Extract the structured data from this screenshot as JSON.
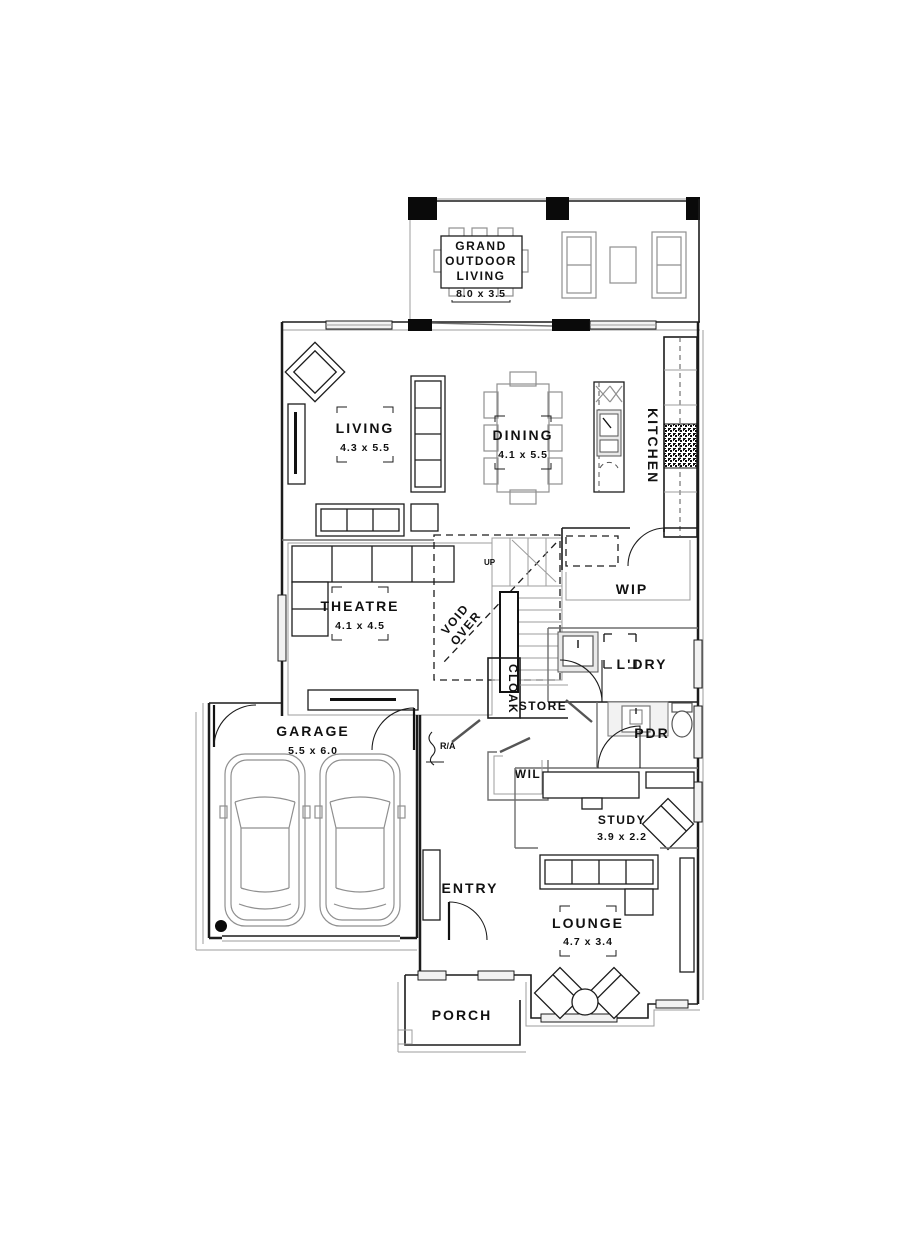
{
  "drawing": {
    "type": "floor-plan",
    "background": "#ffffff",
    "line_color": "#1c1c1c",
    "light_line_color": "#9d9d9d"
  },
  "rooms": {
    "grand_outdoor_living": {
      "line1": "GRAND",
      "line2": "OUTDOOR",
      "line3": "LIVING",
      "dims": "8.0 x 3.5"
    },
    "living": {
      "label": "LIVING",
      "dims": "4.3 x 5.5"
    },
    "dining": {
      "label": "DINING",
      "dims": "4.1 x 5.5"
    },
    "kitchen": {
      "label": "KITCHEN"
    },
    "theatre": {
      "label": "THEATRE",
      "dims": "4.1 x 4.5"
    },
    "void": {
      "line1": "VOID",
      "line2": "OVER"
    },
    "stairs": {
      "up_label": "UP"
    },
    "wip": {
      "label": "WIP"
    },
    "laundry": {
      "label": "L'DRY"
    },
    "cloak": {
      "label": "CLOAK"
    },
    "store": {
      "label": "STORE"
    },
    "powder": {
      "label": "PDR"
    },
    "walk_in_linen": {
      "label": "WIL"
    },
    "return_air": {
      "label": "R/A"
    },
    "garage": {
      "label": "GARAGE",
      "dims": "5.5 x 6.0"
    },
    "entry": {
      "label": "ENTRY"
    },
    "study": {
      "label": "STUDY",
      "dims": "3.9 x 2.2"
    },
    "lounge": {
      "label": "LOUNGE",
      "dims": "4.7 x 3.4"
    },
    "porch": {
      "label": "PORCH"
    }
  }
}
